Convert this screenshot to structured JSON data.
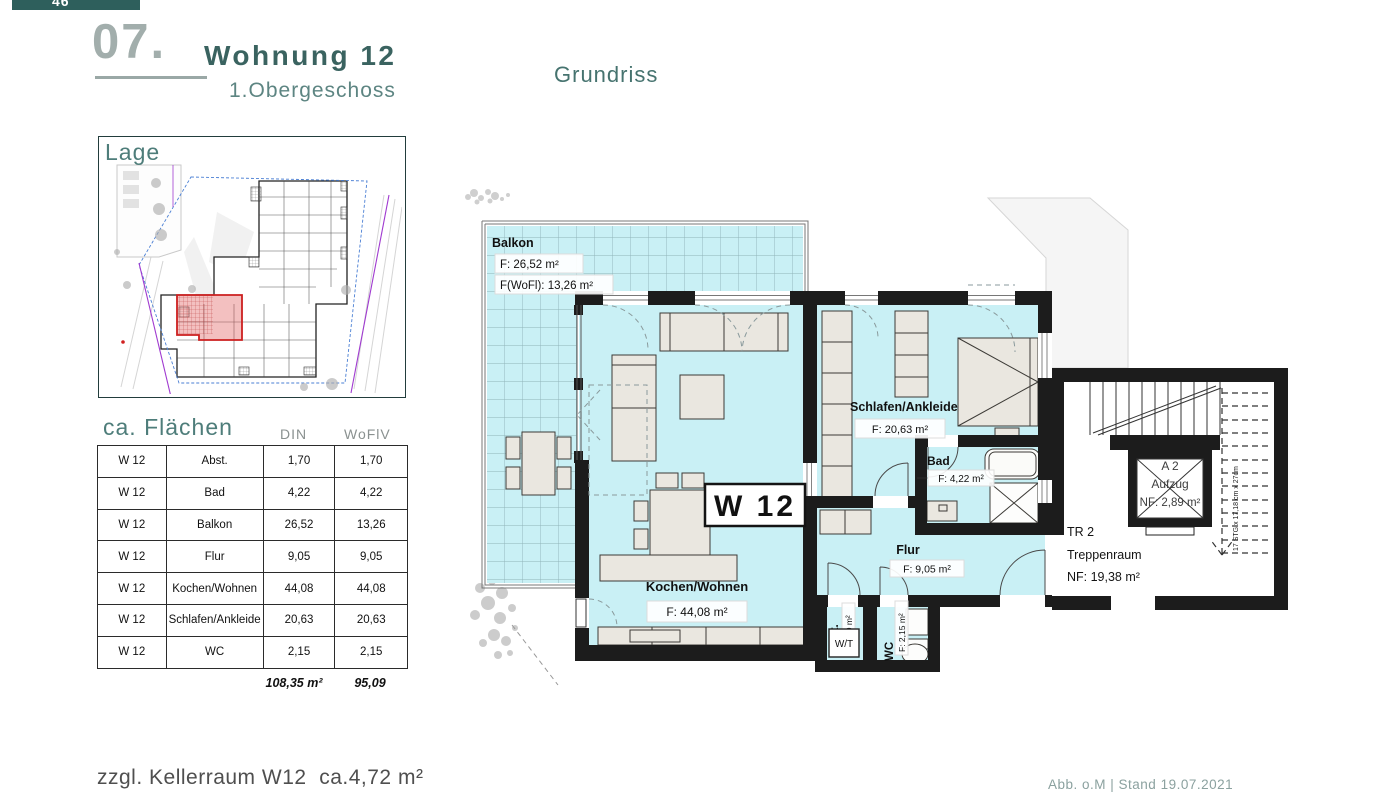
{
  "page": {
    "badge": "46",
    "section_number": "07.",
    "title": "Wohnung 12",
    "subtitle": "1.Obergeschoss",
    "plan_heading": "Grundriss",
    "map_heading": "Lage",
    "footer_note": "zzgl. Kellerraum W12  ca.4,72 m²",
    "footer_meta": "Abb. o.M | Stand 19.07.2021"
  },
  "area_table": {
    "title": "ca. Flächen",
    "columns": {
      "din": "DIN",
      "woflv": "WoFlV"
    },
    "rows": [
      {
        "unit": "W 12",
        "room": "Abst.",
        "din": "1,70",
        "woflv": "1,70"
      },
      {
        "unit": "W 12",
        "room": "Bad",
        "din": "4,22",
        "woflv": "4,22"
      },
      {
        "unit": "W 12",
        "room": "Balkon",
        "din": "26,52",
        "woflv": "13,26"
      },
      {
        "unit": "W 12",
        "room": "Flur",
        "din": "9,05",
        "woflv": "9,05"
      },
      {
        "unit": "W 12",
        "room": "Kochen/Wohnen",
        "din": "44,08",
        "woflv": "44,08"
      },
      {
        "unit": "W 12",
        "room": "Schlafen/Ankleide",
        "din": "20,63",
        "woflv": "20,63"
      },
      {
        "unit": "W 12",
        "room": "WC",
        "din": "2,15",
        "woflv": "2,15"
      }
    ],
    "totals": {
      "din": "108,35 m²",
      "woflv": "95,09"
    }
  },
  "floor_plan": {
    "unit_label": "W 12",
    "balkon": {
      "name": "Balkon",
      "area_din": "F: 26,52 m²",
      "area_wofl": "F(WoFl): 13,26 m²"
    },
    "kochen_wohnen": {
      "name": "Kochen/Wohnen",
      "area": "F: 44,08 m²"
    },
    "schlafen": {
      "name": "Schlafen/Ankleide",
      "area": "F: 20,63 m²"
    },
    "bad": {
      "name": "Bad",
      "area": "F: 4,22 m²"
    },
    "flur": {
      "name": "Flur",
      "area": "F: 9,05 m²"
    },
    "abst": {
      "name": "Abst.",
      "area": "F: 1,70 m²"
    },
    "wc": {
      "name": "WC",
      "area": "F: 2,15 m²"
    },
    "wt_label": "W/T",
    "aufzug": {
      "line1": "A 2",
      "line2": "Aufzug",
      "line3": "NF: 2,89 m²"
    },
    "treppenraum": {
      "line1": "TR 2",
      "line2": "Treppenraum",
      "line3": "NF:  19,38 m²"
    },
    "stair_note": "17 STG x 17,18 cm x 27cm"
  },
  "colors": {
    "brand_teal": "#2e5f5c",
    "heading_teal": "#3a6360",
    "subheading_teal": "#5d8582",
    "muted_gray": "#a2aeac",
    "room_fill": "#c9f0f5",
    "wall": "#1c1c1c",
    "highlight_red": "#c0392b"
  }
}
